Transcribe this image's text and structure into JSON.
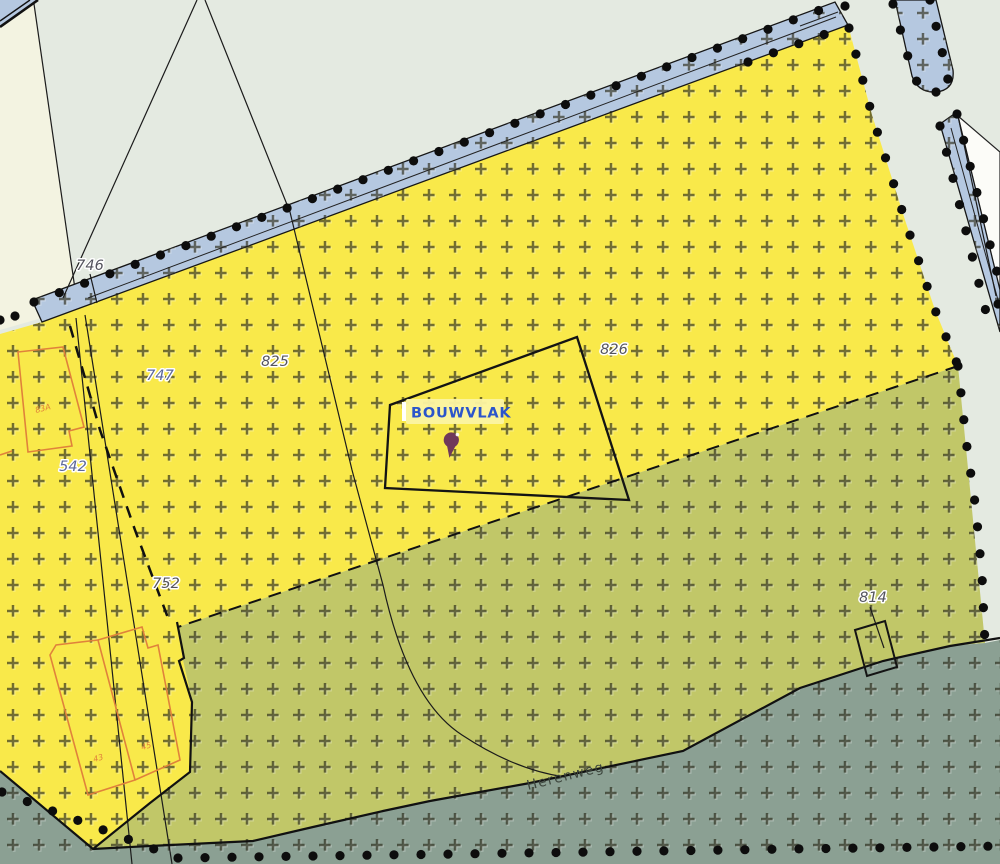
{
  "labels": {
    "building_area": "BOUWVLAK",
    "street_name": "Herenweg",
    "parcel_numbers": {
      "n746": "746",
      "n747": "747",
      "n825": "825",
      "n826": "826",
      "n542": "542",
      "n752": "752",
      "n814": "814"
    },
    "house_numbers": {
      "h83a": "83A",
      "h43": "43",
      "h45": "45"
    }
  },
  "colors": {
    "background": "#e4eae1",
    "zone_yellow": "#f9e94a",
    "zone_olive": "#c1c768",
    "zone_gray_green": "#8ba093",
    "zone_blue_strip": "#b5c8e0",
    "zone_white": "#fcfcf8",
    "zone_cream": "#f3f3e1",
    "building_outline": "#e0823b",
    "label_box": "#fbf4a2",
    "label_text": "#2b55cb",
    "marker_pin": "#70395a",
    "parcel_number_dark": "#55555e",
    "parcel_number_blue": "#5d6899",
    "street_text": "#3c453c",
    "boundary_dot": "#0d0d0d"
  }
}
